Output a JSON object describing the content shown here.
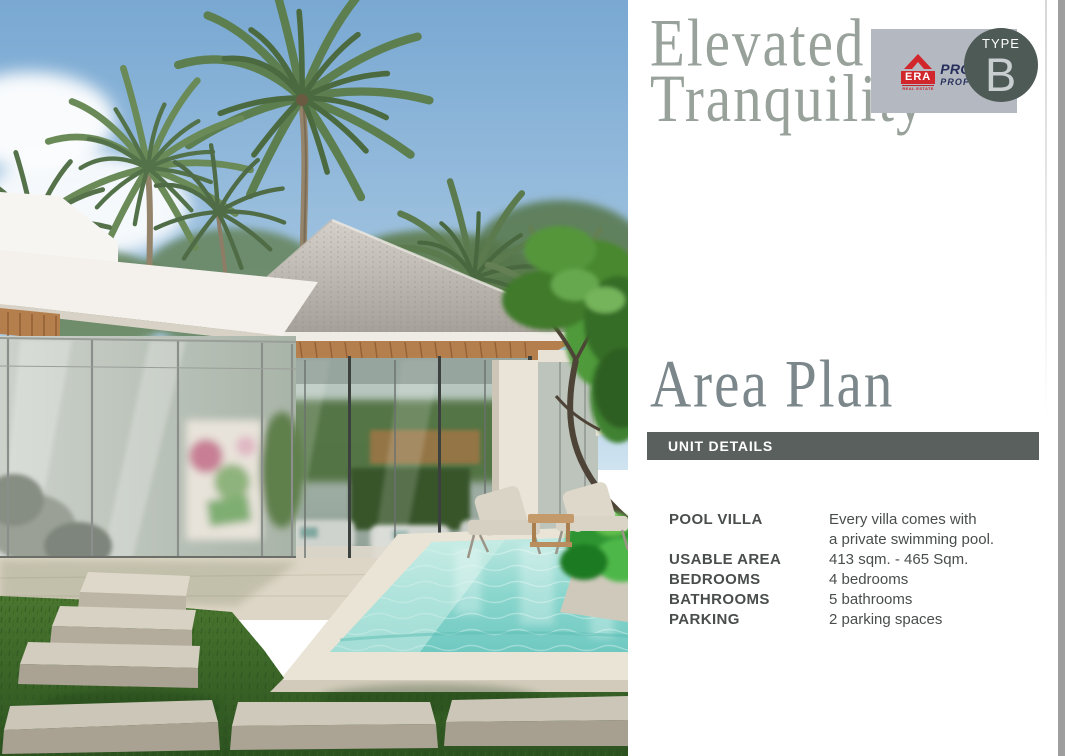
{
  "header": {
    "title_line1": "Elevated",
    "title_line2": "Tranquility"
  },
  "brand": {
    "era": "ERA",
    "real_estate": "REAL ESTATE",
    "prompt": "PROMPT",
    "property": "PROPERTY"
  },
  "type_badge": {
    "label": "TYPE",
    "value": "B"
  },
  "area_plan": {
    "heading": "Area Plan",
    "bar_title": "UNIT DETAILS",
    "rows": [
      {
        "label": "POOL VILLA",
        "value": "Every villa comes with\na private swimming pool."
      },
      {
        "label": "USABLE AREA",
        "value": "413 sqm. - 465 Sqm."
      },
      {
        "label": "BEDROOMS",
        "value": "4 bedrooms"
      },
      {
        "label": "BATHROOMS",
        "value": "5 bathrooms"
      },
      {
        "label": "PARKING",
        "value": "2 parking spaces"
      }
    ]
  },
  "colors": {
    "title": "#98a29b",
    "heading": "#7b878b",
    "unit_bar_bg": "#5a605e",
    "type_badge_bg": "#4d5a55",
    "logo_box_bg": "#b4b8c0",
    "brand_red": "#d2262d",
    "brand_navy": "#27305c",
    "body_text": "#494e4d"
  }
}
